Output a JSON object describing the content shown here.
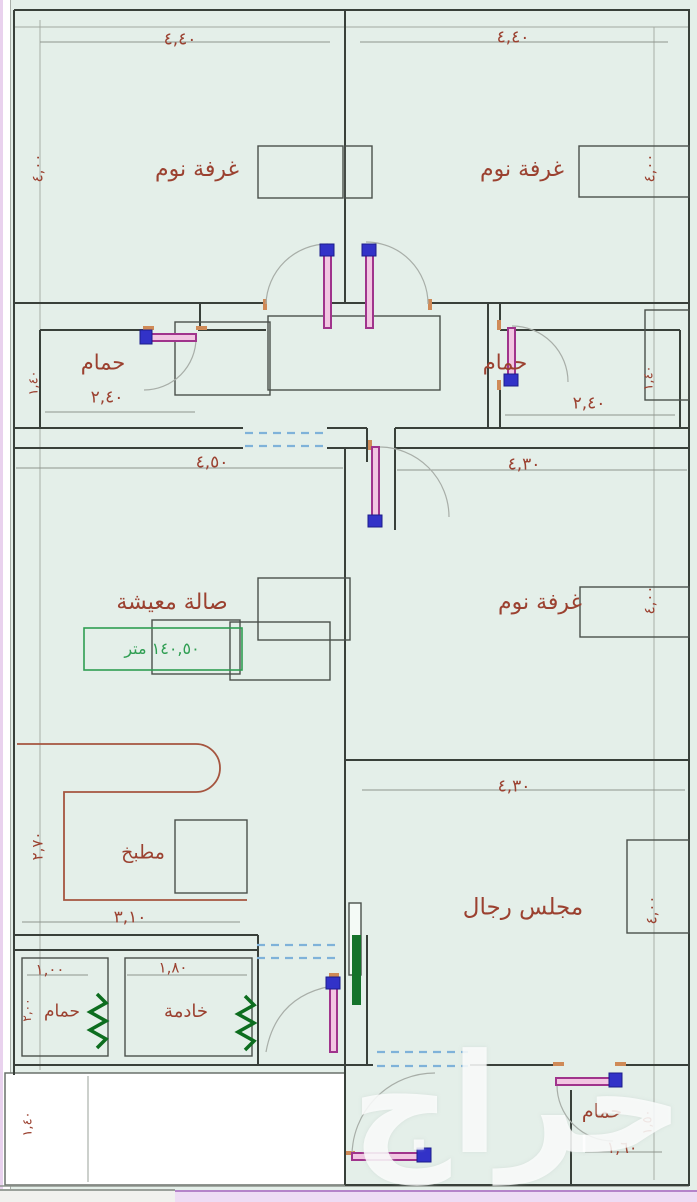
{
  "plan_title": "floor-plan",
  "rooms": {
    "bedroom_tl": "غرفة نوم",
    "bedroom_tr": "غرفة نوم",
    "bedroom_mid": "غرفة نوم",
    "bath_left": "حمام",
    "bath_right": "حمام",
    "living": "صالة معيشة",
    "kitchen": "مطبخ",
    "majlis": "مجلس رجال",
    "maid": "خادمة",
    "bath_small": "حمام",
    "bath_bottom": "حمام"
  },
  "area_label": "١٤٠,٥٠ متر",
  "watermark_text": "حراج",
  "dims": {
    "bedroom_tl_w": "٤,٤٠",
    "bedroom_tr_w": "٤,٤٠",
    "bath_left_w": "٢,٤٠",
    "bath_right_w": "٢,٤٠",
    "living_w": "٤,٥٠",
    "bedroom_mid_w": "٤,٣٠",
    "majlis_w": "٤,٣٠",
    "kitchen_w": "٣,١٠",
    "bath_small_w": "١,٠٠",
    "maid_w": "١,٨٠",
    "bath_bottom_w": "١,٦٠",
    "bedroom_tl_h": "٤,٠٠",
    "bedroom_tr_h": "٤,٠٠",
    "bedroom_mid_h": "٤,٠٠",
    "majlis_h": "٤,٠٠",
    "kitchen_h": "٢,٧٠",
    "bath_left_h": "١,٤٠",
    "bath_right_h": "١,٤٠",
    "bath_small_h": "٢,٠٠",
    "balcony_h": "١,٤٠",
    "bath_bottom_h": "١,٥٠"
  },
  "colors": {
    "background": "#e4efe9",
    "wall": "#39403a",
    "label": "#9b4130",
    "dimension": "#8e948d",
    "door_leaf": "#a0348c",
    "door_hinge": "#3232c8",
    "door_jamb": "#cf8a57",
    "dashed_opening": "#7fb2d9",
    "symbol_green": "#0d6d1f",
    "area_green": "#2f9e52",
    "counter": "#a5553f",
    "footer_band": "#eedcf4",
    "footer_border": "#b583c9"
  }
}
